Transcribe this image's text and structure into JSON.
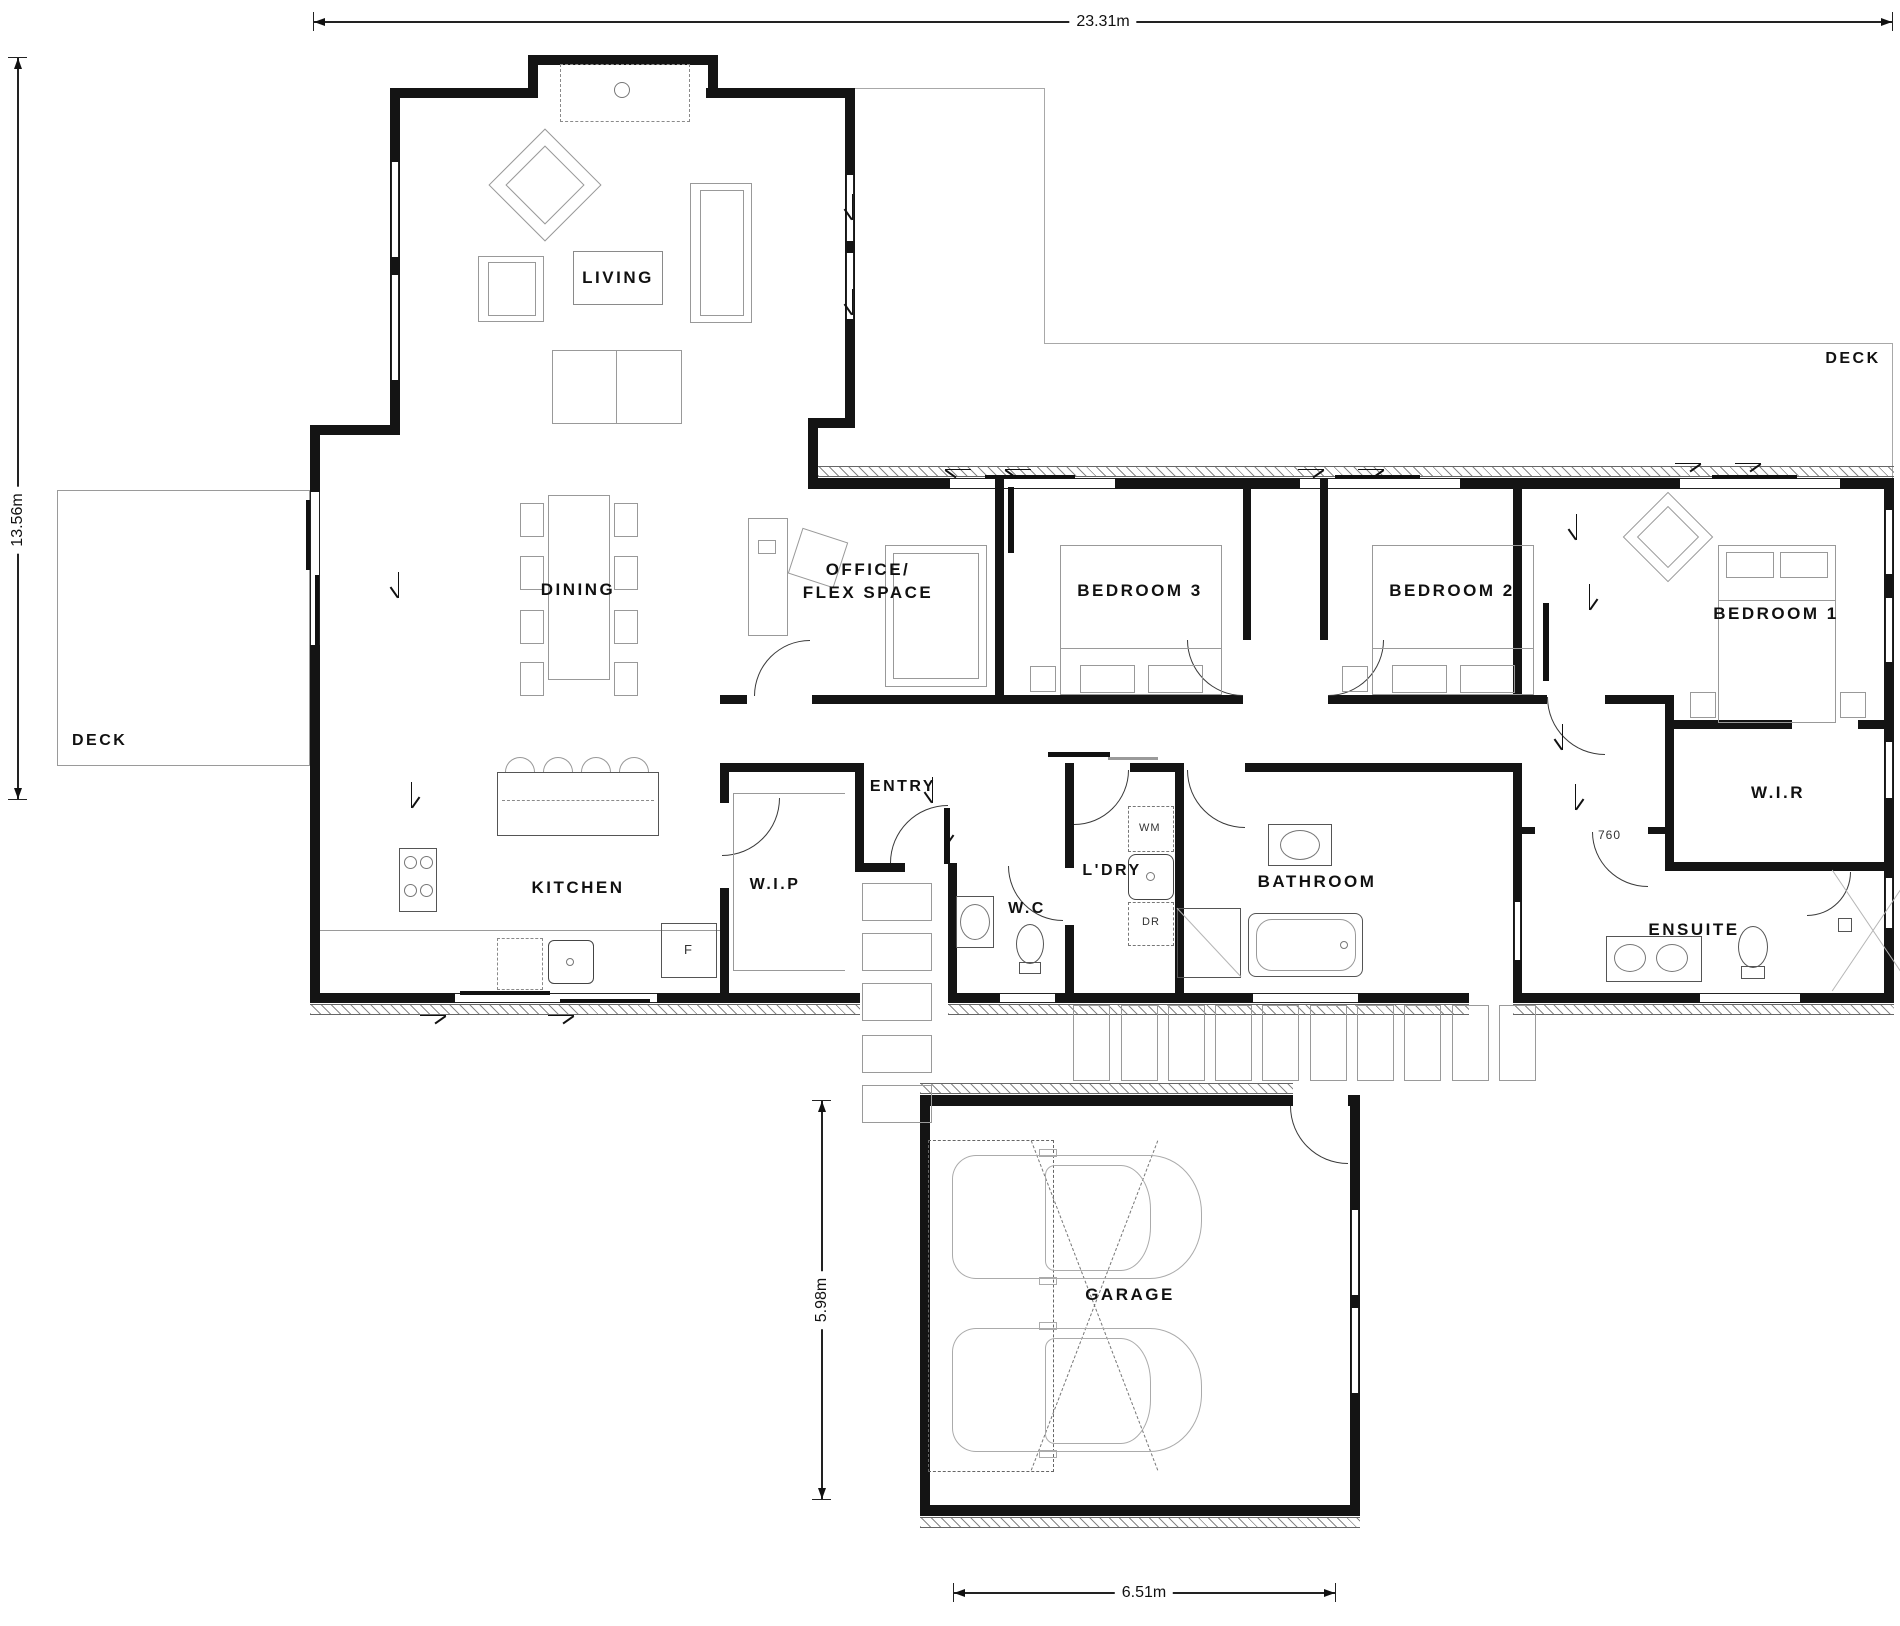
{
  "dimensions": {
    "overall_width": "23.31m",
    "overall_height": "13.56m",
    "garage_depth": "5.98m",
    "garage_width": "6.51m",
    "ensuite_door": "760"
  },
  "areas": {
    "living": "LIVING",
    "dining": "DINING",
    "kitchen": "KITCHEN",
    "pantry": "W.I.P",
    "office1": "OFFICE/",
    "office2": "FLEX SPACE",
    "bed3": "BEDROOM 3",
    "bed2": "BEDROOM 2",
    "bed1": "BEDROOM 1",
    "wir": "W.I.R",
    "ensuite": "ENSUITE",
    "entry": "ENTRY",
    "wc": "W.C",
    "laundry": "L'DRY",
    "bathroom": "BATHROOM",
    "garage": "GARAGE",
    "deck_left": "DECK",
    "deck_right": "DECK"
  },
  "appliances": {
    "wm": "WM",
    "dr": "DR",
    "fridge": "F"
  },
  "colors": {
    "wall": "#141414",
    "furniture": "#999999",
    "text": "#111111"
  }
}
